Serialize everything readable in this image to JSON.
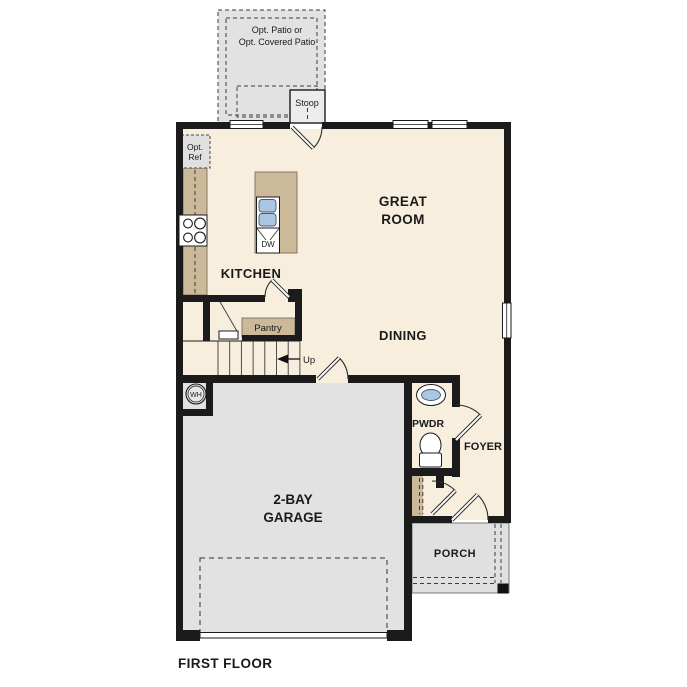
{
  "plan": {
    "title": "FIRST FLOOR",
    "colors": {
      "wall": "#1b1b1b",
      "floor": "#f7eede",
      "hardscape": "#e2e2e2",
      "porch": "#e0e0e0",
      "counter": "#cbb99a",
      "fixture_blue": "#a9c7e3",
      "line": "#1b1b1b",
      "text": "#1a1a1a"
    },
    "labels": {
      "patio_line1": "Opt. Patio or",
      "patio_line2": "Opt. Covered Patio",
      "stoop": "Stoop",
      "opt_ref_line1": "Opt.",
      "opt_ref_line2": "Ref",
      "great_line1": "GREAT",
      "great_line2": "ROOM",
      "kitchen": "KITCHEN",
      "dw": "DW",
      "pantry": "Pantry",
      "dining": "DINING",
      "up": "Up",
      "wh": "WH",
      "pwdr": "PWDR",
      "foyer": "FOYER",
      "garage_line1": "2-BAY",
      "garage_line2": "GARAGE",
      "porch": "PORCH"
    }
  }
}
